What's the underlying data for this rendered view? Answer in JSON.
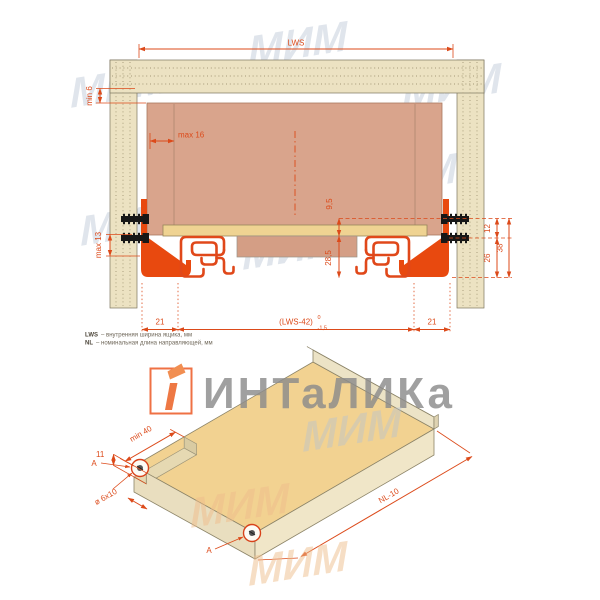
{
  "watermarks": {
    "brand": "ИНТаЛИКа",
    "mim": "МИМ"
  },
  "top_view": {
    "lws": "LWS",
    "min6": "min 6",
    "max16": "max 16",
    "max13": "max 13",
    "h95": "9,5",
    "h285": "28,5",
    "r12": "12",
    "r26": "26",
    "r38": "38",
    "b21_left": "21",
    "b_lws42": "(LWS-42)",
    "b_tol_top": "0",
    "b_tol_bottom": "-1,5",
    "b21_right": "21"
  },
  "iso_view": {
    "min40": "min 40",
    "h11": "11",
    "a_left": "A",
    "a_front": "A",
    "slot": "ø 6x10",
    "nl": "NL-10"
  },
  "footnotes": {
    "l1_term": "LWS",
    "l1_rest": "– внутренняя ширина ящика, мм",
    "l2_term": "NL",
    "l2_rest": "– номинальная длина направляющей, мм"
  },
  "colors": {
    "dimension": "#dc4a1a",
    "slide_profile": "#e0481a",
    "bracket": "#e8490f",
    "wood": "#ece2c2",
    "drawer_back_panel": "#d9a48c",
    "drawer_bottom_panel": "#efd392",
    "watermark_blue": "#b6c2d2",
    "watermark_orange": "#efbe8c",
    "brand_gray": "#8c8c8c",
    "logo_orange": "#ee6230"
  }
}
